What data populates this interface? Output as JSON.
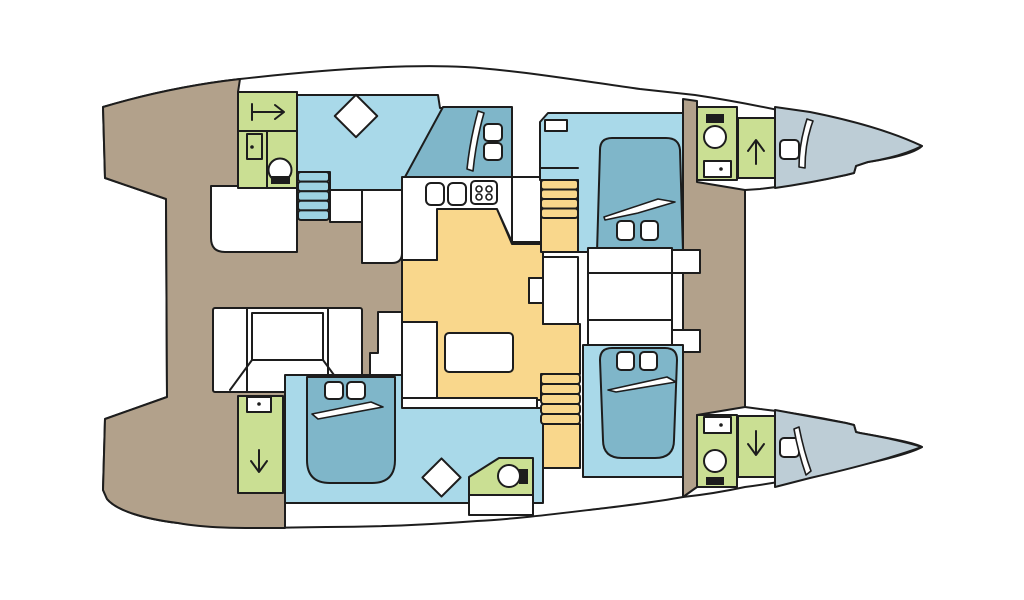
{
  "diagram": {
    "type": "boat-floorplan",
    "subject": "catamaran-deck-layout",
    "orientation": "bow-right"
  },
  "colors": {
    "outline": "#1d1d1d",
    "hull": "#ffffff",
    "deck": "#b2a18b",
    "cabin": "#a9d9e9",
    "bed": "#7fb6c9",
    "stairs": "#9dd2e2",
    "wet": "#cadf93",
    "saloon": "#f9d78c",
    "bow": "#bdcdd6",
    "furniture": "#ffffff",
    "icon": "#1d1d1d"
  },
  "icons": {
    "shower_arrow_right": "arrow-right-with-bar",
    "shower_arrow_up": "arrow-up",
    "shower_arrow_down": "arrow-down",
    "toilet": "circle-with-black-seat",
    "washbasin": "box-with-drain-dot",
    "door": "rect-with-handle-dot",
    "galley_sink": "rounded-basin",
    "stove": "four-ring-burner",
    "deck_hatch": "rotated-square",
    "bow_hatch": "rounded-square",
    "pillow": "rounded-square",
    "duvet": "swoosh-line",
    "stairs": "tread-stack"
  },
  "regions": [
    "aft-deck",
    "foredeck",
    "cockpit",
    "saloon",
    "galley",
    "nav-table",
    "port-aft-head",
    "port-aft-cabin",
    "port-fwd-cabin",
    "port-bow-head",
    "port-bow-shower",
    "port-forepeak",
    "stbd-aft-shower",
    "stbd-aft-cabin",
    "stbd-aft-head",
    "stbd-fwd-cabin",
    "stbd-bow-head",
    "stbd-bow-shower",
    "stbd-forepeak",
    "fwd-storage"
  ]
}
